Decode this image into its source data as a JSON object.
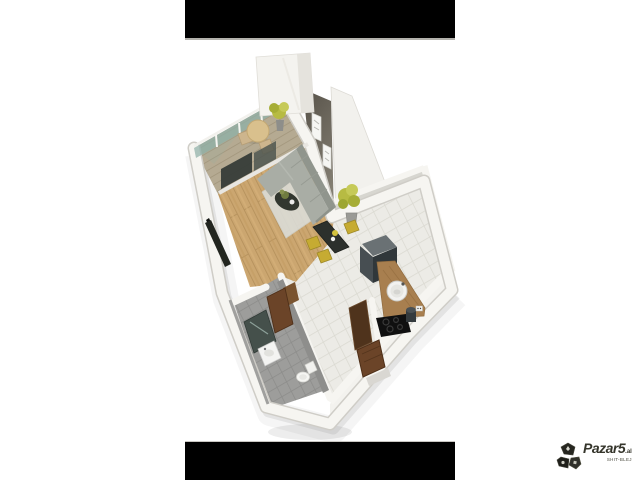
{
  "page": {
    "background": "#ffffff"
  },
  "photo": {
    "letterbox_color": "#000000",
    "separator_color": "#b3b1ac",
    "content": "3d-rendered-studio-apartment-floor-plan"
  },
  "watermark": {
    "brand": "Pazar5",
    "domain_suffix": ".al",
    "tagline": "SHIT-BLEJ",
    "text_color": "#35352b"
  },
  "floorplan": {
    "view": "isometric-3d-render",
    "rooms": [
      {
        "id": "balcony",
        "features": [
          "glass-balustrade",
          "round-table",
          "two-chairs",
          "plant"
        ]
      },
      {
        "id": "living-room",
        "features": [
          "accent-wall",
          "two-framed-pictures",
          "sectional-sofa",
          "rug",
          "round-coffee-table",
          "tv-sideboard",
          "floor-plant"
        ]
      },
      {
        "id": "dining-area",
        "features": [
          "dark-table",
          "vase-with-flowers",
          "three-yellow-chairs"
        ]
      },
      {
        "id": "kitchen",
        "features": [
          "tall-fridge-unit",
          "wood-counter",
          "round-sink",
          "black-cooktop",
          "bin"
        ]
      },
      {
        "id": "hallway",
        "features": [
          "tile-floor",
          "entry-door",
          "brown-cabinet"
        ]
      },
      {
        "id": "bathroom",
        "features": [
          "gray-tiles",
          "shower",
          "square-sink",
          "toilet",
          "door"
        ]
      }
    ],
    "palette": {
      "wall": "#f6f5f1",
      "wall_edge": "#cfcdc7",
      "accent_wall_dark": "#565148",
      "accent_wall_light": "#7d786d",
      "wood_floor": "#cba670",
      "tile_floor": "#ecebe6",
      "bathroom_tile": "#9d9d9b",
      "sofa_gray": "#a9ada5",
      "chair_yellow": "#c6ab32",
      "plant_green": "#b7bb43",
      "counter_wood": "#a87f4f",
      "door_brown": "#6b4428",
      "glass_teal": "#8fb0a8",
      "appliance_dark": "#30373a"
    }
  }
}
